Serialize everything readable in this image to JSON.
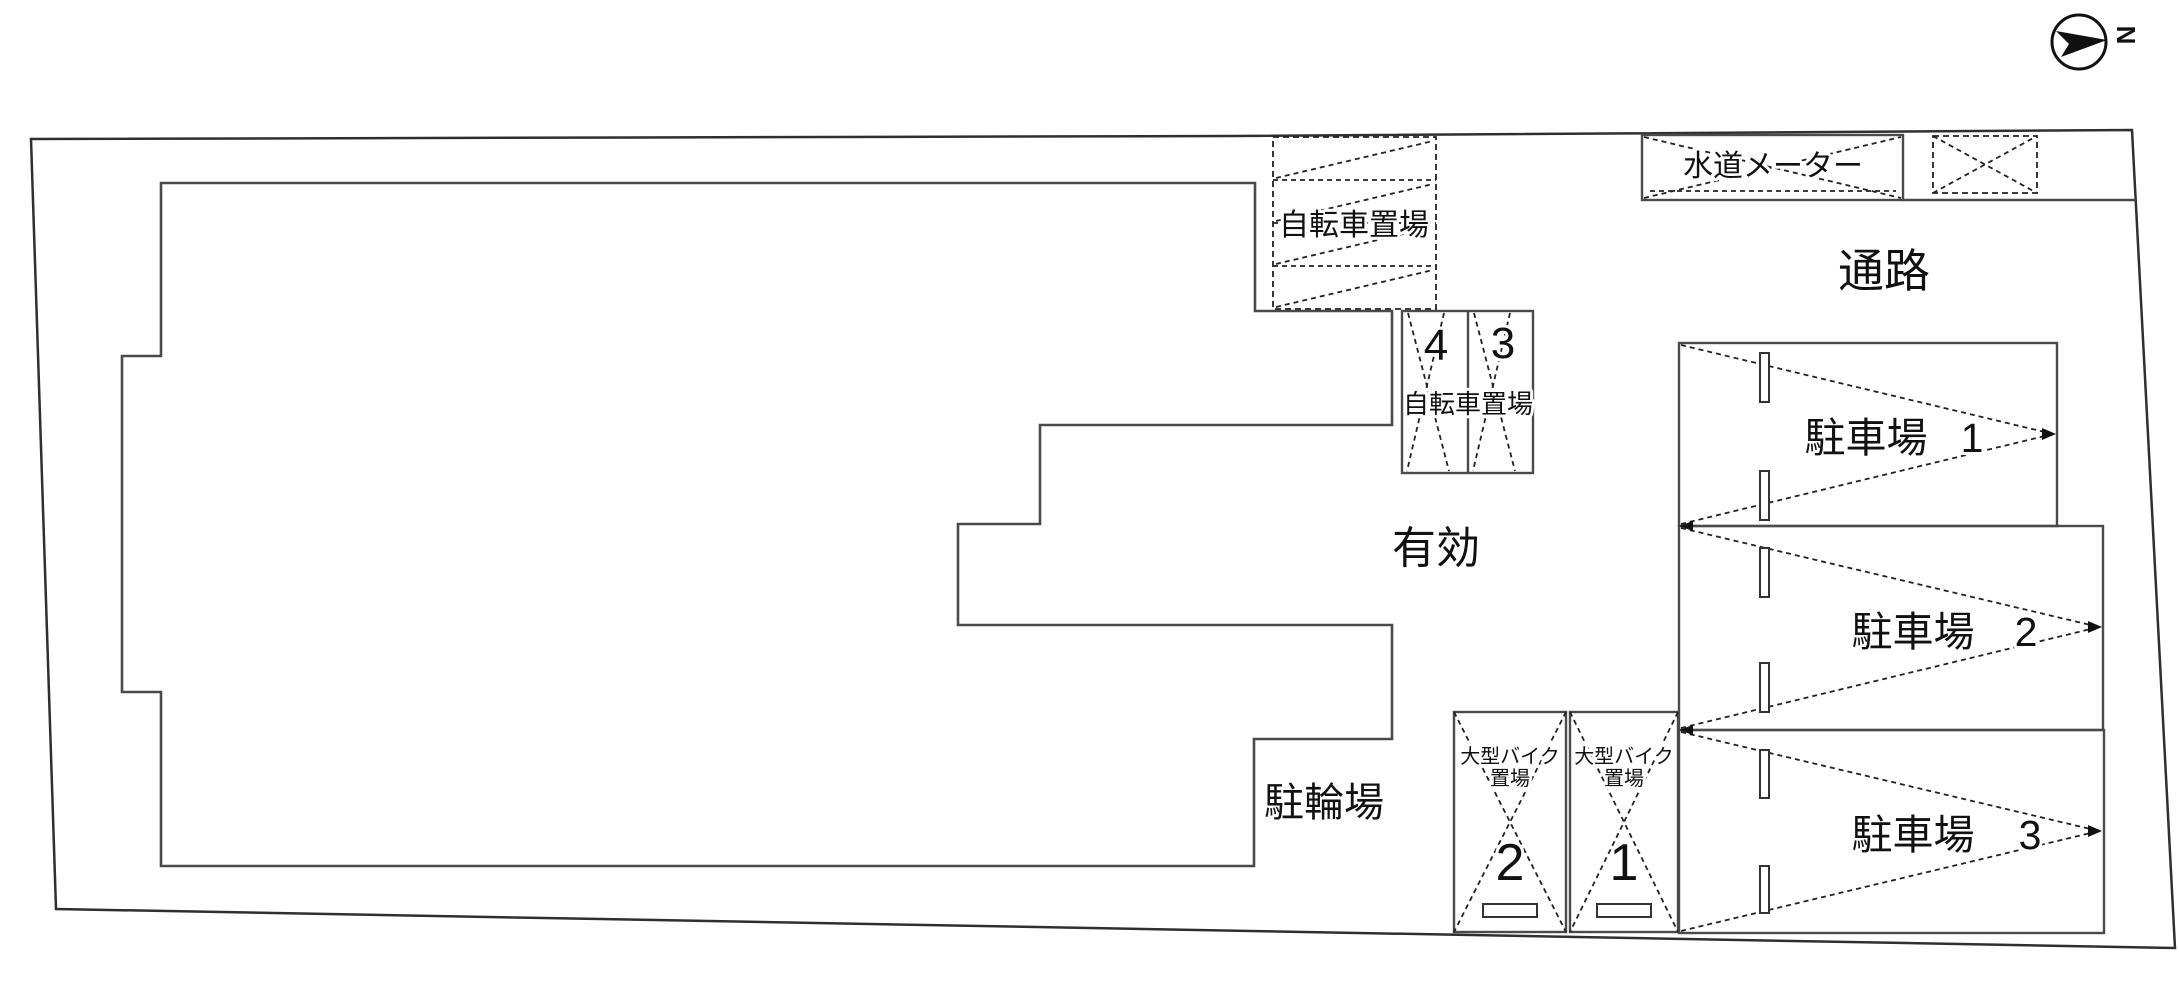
{
  "compass": {
    "north_label": "N"
  },
  "labels": {
    "passage": "通路",
    "effective": "有効",
    "bicycle_area": "駐輪場"
  },
  "water_meter": {
    "label": "水道メーター"
  },
  "bicycle_top": {
    "label": "自転車置場"
  },
  "bicycle_rack": {
    "label": "自転車置場",
    "stall_left": "4",
    "stall_right": "3"
  },
  "motorcycle": {
    "label_line1": "大型バイク",
    "label_line2": "置場",
    "stall_left": "2",
    "stall_right": "1"
  },
  "parking": {
    "label": "駐車場",
    "spaces": [
      {
        "number": "1"
      },
      {
        "number": "2"
      },
      {
        "number": "3"
      }
    ]
  },
  "colors": {
    "boundary": "#2f2f2f",
    "line": "#4a4a4a",
    "text": "#111111",
    "background": "#ffffff"
  }
}
